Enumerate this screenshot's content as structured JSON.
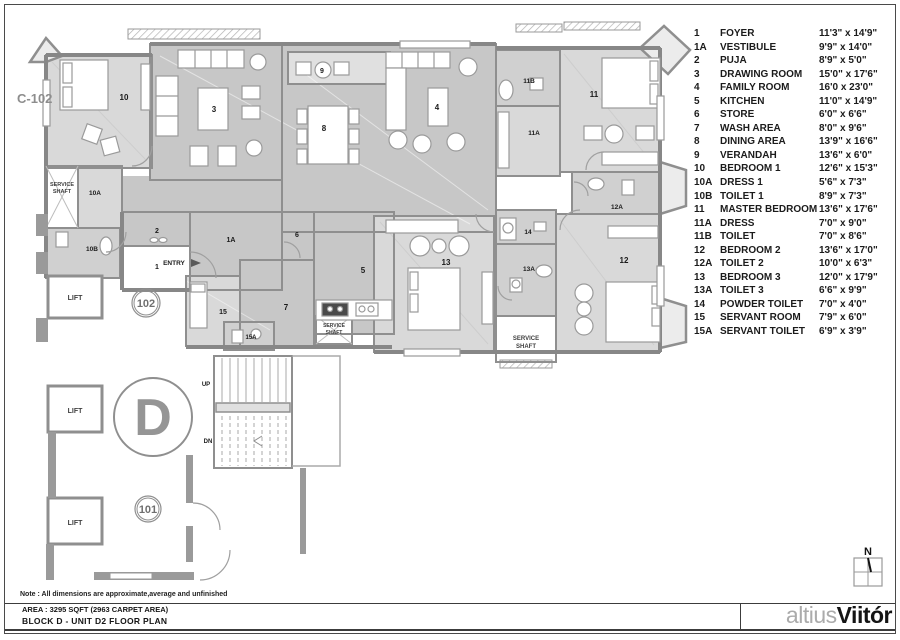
{
  "sheet": {
    "note": "Note : All dimensions are approximate,average and unfinished",
    "area_line": "AREA : 3295 SQFT (2963 CARPET AREA)",
    "block_line": "BLOCK D - UNIT  D2  FLOOR PLAN",
    "north_label": "N"
  },
  "logo": {
    "light": "altius",
    "bold": "Viitór"
  },
  "legend": {
    "items": [
      {
        "id": "1",
        "name": "FOYER",
        "size": "11'3\" x 14'9\""
      },
      {
        "id": "1A",
        "name": "VESTIBULE",
        "size": "9'9\" x 14'0\""
      },
      {
        "id": "2",
        "name": "PUJA",
        "size": "8'9\" x 5'0\""
      },
      {
        "id": "3",
        "name": "DRAWING ROOM",
        "size": "15'0\" x 17'6\""
      },
      {
        "id": "4",
        "name": "FAMILY ROOM",
        "size": "16'0 x 23'0\""
      },
      {
        "id": "5",
        "name": "KITCHEN",
        "size": "11'0\" x 14'9\""
      },
      {
        "id": "6",
        "name": "STORE",
        "size": "6'0\" x 6'6\""
      },
      {
        "id": "7",
        "name": "WASH AREA",
        "size": "8'0\" x 9'6\""
      },
      {
        "id": "8",
        "name": "DINING AREA",
        "size": "13'9\" x 16'6\""
      },
      {
        "id": "9",
        "name": "VERANDAH",
        "size": "13'6\" x 6'0\""
      },
      {
        "id": "10",
        "name": "BEDROOM 1",
        "size": "12'6\" x 15'3\""
      },
      {
        "id": "10A",
        "name": "DRESS 1",
        "size": "5'6\" x 7'3\""
      },
      {
        "id": "10B",
        "name": "TOILET  1",
        "size": "8'9\" x 7'3\""
      },
      {
        "id": "11",
        "name": "MASTER BEDROOM",
        "size": "13'6\" x 17'6\""
      },
      {
        "id": "11A",
        "name": "DRESS",
        "size": "7'0\" x 9'0\""
      },
      {
        "id": "11B",
        "name": "TOILET",
        "size": "7'0\" x 8'6\""
      },
      {
        "id": "12",
        "name": "BEDROOM 2",
        "size": "13'6\" x 17'0\""
      },
      {
        "id": "12A",
        "name": "TOILET  2",
        "size": "10'0\" x 6'3\""
      },
      {
        "id": "13",
        "name": "BEDROOM 3",
        "size": "12'0\" x 17'9\""
      },
      {
        "id": "13A",
        "name": "TOILET  3",
        "size": "6'6\" x 9'9\""
      },
      {
        "id": "14",
        "name": "POWDER TOILET",
        "size": "7'0\" x 4'0\""
      },
      {
        "id": "15",
        "name": "SERVANT ROOM",
        "size": "7'9\" x 6'0\""
      },
      {
        "id": "15A",
        "name": "SERVANT TOILET",
        "size": "6'9\" x 3'9\""
      }
    ]
  },
  "plan": {
    "colors": {
      "wall": "#8f8f8f",
      "room_light": "#d9d9d9",
      "room_mid": "#c7c7c7",
      "toilet": "#d0d0d0",
      "label": "#1a1a1a",
      "marker_gray": "#8d8d8d"
    },
    "labels": [
      {
        "t": "1",
        "x": 157,
        "y": 269,
        "s": 7
      },
      {
        "t": "1A",
        "x": 231,
        "y": 242,
        "s": 7
      },
      {
        "t": "2",
        "x": 157,
        "y": 233,
        "s": 7
      },
      {
        "t": "3",
        "x": 214,
        "y": 112,
        "s": 8
      },
      {
        "t": "4",
        "x": 437,
        "y": 110,
        "s": 8
      },
      {
        "t": "5",
        "x": 363,
        "y": 273,
        "s": 8
      },
      {
        "t": "6",
        "x": 297,
        "y": 237,
        "s": 7
      },
      {
        "t": "7",
        "x": 286,
        "y": 310,
        "s": 8
      },
      {
        "t": "8",
        "x": 324,
        "y": 131,
        "s": 8
      },
      {
        "t": "9",
        "x": 322,
        "y": 73,
        "s": 7
      },
      {
        "t": "10",
        "x": 124,
        "y": 100,
        "s": 8
      },
      {
        "t": "10A",
        "x": 95,
        "y": 195,
        "s": 6.5
      },
      {
        "t": "10B",
        "x": 92,
        "y": 251,
        "s": 6.5
      },
      {
        "t": "11",
        "x": 594,
        "y": 97,
        "s": 8
      },
      {
        "t": "11A",
        "x": 534,
        "y": 135,
        "s": 6.5
      },
      {
        "t": "11B",
        "x": 529,
        "y": 83,
        "s": 6.5
      },
      {
        "t": "12",
        "x": 624,
        "y": 263,
        "s": 8
      },
      {
        "t": "12A",
        "x": 617,
        "y": 209,
        "s": 6.5
      },
      {
        "t": "13",
        "x": 446,
        "y": 265,
        "s": 8
      },
      {
        "t": "13A",
        "x": 529,
        "y": 271,
        "s": 6.5
      },
      {
        "t": "14",
        "x": 528,
        "y": 234,
        "s": 6.5
      },
      {
        "t": "15",
        "x": 223,
        "y": 314,
        "s": 7
      },
      {
        "t": "15A",
        "x": 251,
        "y": 339,
        "s": 6
      },
      {
        "t": "C-102",
        "x": 17,
        "y": 103,
        "s": 13,
        "fill": "#8d8d8d",
        "anchor": "start"
      },
      {
        "t": "LIFT",
        "x": 75,
        "y": 300,
        "s": 7,
        "w": 600,
        "fill": "#3f3f3f"
      },
      {
        "t": "LIFT",
        "x": 75,
        "y": 413,
        "s": 7,
        "w": 600,
        "fill": "#3f3f3f"
      },
      {
        "t": "LIFT",
        "x": 75,
        "y": 525,
        "s": 7,
        "w": 600,
        "fill": "#3f3f3f"
      },
      {
        "t": "SERVICE",
        "x": 62,
        "y": 186,
        "s": 5.5,
        "fill": "#3f3f3f"
      },
      {
        "t": "SHAFT",
        "x": 62,
        "y": 193,
        "s": 5.5,
        "fill": "#3f3f3f"
      },
      {
        "t": "SERVICE",
        "x": 334,
        "y": 327,
        "s": 5,
        "fill": "#3f3f3f"
      },
      {
        "t": "SHAFT",
        "x": 334,
        "y": 334,
        "s": 5,
        "fill": "#3f3f3f"
      },
      {
        "t": "SERVICE",
        "x": 526,
        "y": 340,
        "s": 6,
        "fill": "#3f3f3f"
      },
      {
        "t": "SHAFT",
        "x": 526,
        "y": 348,
        "s": 6,
        "fill": "#3f3f3f"
      },
      {
        "t": "ENTRY",
        "x": 174,
        "y": 265,
        "s": 6.5
      },
      {
        "t": "UP",
        "x": 206,
        "y": 386,
        "s": 6
      },
      {
        "t": "DN",
        "x": 208,
        "y": 443,
        "s": 6
      },
      {
        "t": "102",
        "x": 146,
        "y": 307,
        "s": 11,
        "fill": "#6f6f6f"
      },
      {
        "t": "101",
        "x": 148,
        "y": 513,
        "s": 11,
        "fill": "#6f6f6f"
      },
      {
        "t": "D",
        "x": 153,
        "y": 435,
        "s": 52,
        "fill": "#959595"
      },
      {
        "t": "N",
        "x": 868,
        "y": 555,
        "s": 11,
        "fill": "#111111"
      }
    ]
  }
}
